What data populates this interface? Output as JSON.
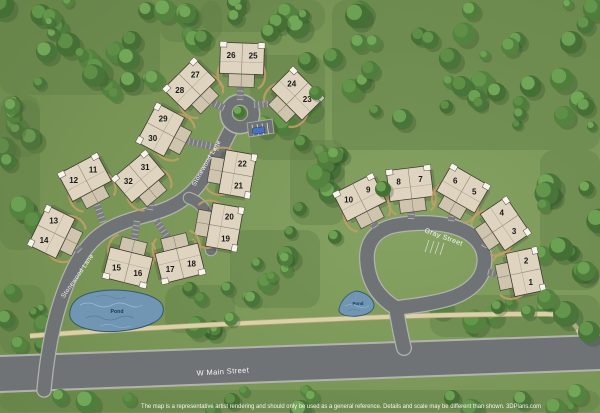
{
  "map": {
    "streets": [
      {
        "id": "stonewood-upper",
        "label": "Stonewood Lane"
      },
      {
        "id": "stonewood-lower",
        "label": "Stonewood Lane"
      },
      {
        "id": "gray",
        "label": "Gray Street"
      },
      {
        "id": "w-main",
        "label": "W Main Street"
      }
    ],
    "ponds": [
      {
        "label": "Pond"
      },
      {
        "label": "Pond"
      }
    ],
    "buildings": [
      {
        "units": [
          "26",
          "25"
        ]
      },
      {
        "units": [
          "28",
          "27"
        ]
      },
      {
        "units": [
          "24",
          "23"
        ]
      },
      {
        "units": [
          "30",
          "29"
        ]
      },
      {
        "units": [
          "12",
          "11"
        ]
      },
      {
        "units": [
          "32",
          "31"
        ]
      },
      {
        "units": [
          "14",
          "13"
        ]
      },
      {
        "units": [
          "22",
          "21"
        ]
      },
      {
        "units": [
          "20",
          "19"
        ]
      },
      {
        "units": [
          "16",
          "15"
        ]
      },
      {
        "units": [
          "18",
          "17"
        ]
      },
      {
        "units": [
          "10",
          "9"
        ]
      },
      {
        "units": [
          "8",
          "7"
        ]
      },
      {
        "units": [
          "6",
          "5"
        ]
      },
      {
        "units": [
          "4",
          "3"
        ]
      },
      {
        "units": [
          "2",
          "1"
        ]
      }
    ],
    "disclaimer": "The map is a representative artist rendering and should only be used as a general reference.  Details and scale may be different than shown.  3DPlans.com",
    "colors": {
      "grass": "#7a9758",
      "forest": "#4a7539",
      "road": "#707376",
      "road_edge": "#b2b3ad",
      "building": "#ded4c0",
      "garage": "#cfc5ae",
      "pond": "#7096b3",
      "walkway": "#dbd1a8",
      "label": "#ffffff"
    }
  }
}
